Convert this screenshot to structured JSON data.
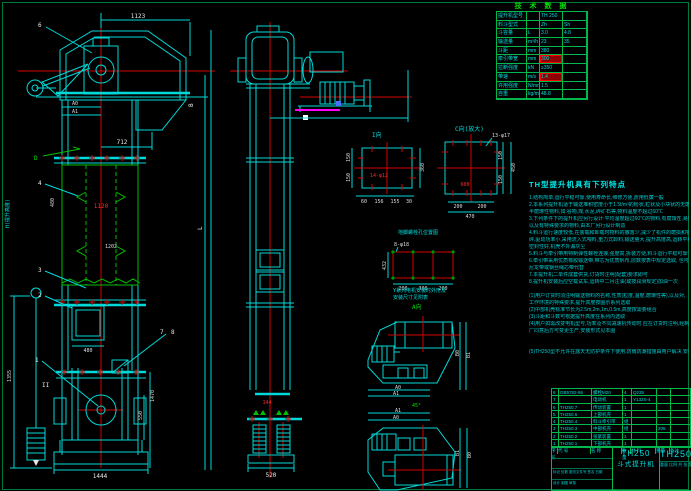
{
  "tech_table": {
    "title": "技 术 数 据",
    "rows": [
      {
        "label": "提升机型号",
        "unit": "",
        "v1": "TH 250",
        "v2": ""
      },
      {
        "label": "料斗型式",
        "unit": "",
        "v1": "Zh",
        "v2": "Sh"
      },
      {
        "label": "斗容量",
        "unit": "L",
        "v1": "3.0",
        "v2": "4.8"
      },
      {
        "label": "输送量",
        "unit": "m³/h",
        "v1": "23",
        "v2": "35"
      },
      {
        "label": "斗距",
        "unit": "mm",
        "v1": "380",
        "v2": ""
      },
      {
        "label": "牵引带宽",
        "unit": "mm",
        "v1": "300",
        "v2": "",
        "hl1": true
      },
      {
        "label": "拉断强度",
        "unit": "kN",
        "v1": "≥350",
        "v2": ""
      },
      {
        "label": "带速",
        "unit": "m/s",
        "v1": "1.4",
        "v2": "",
        "hl1": true
      },
      {
        "label": "许用强度",
        "unit": "N/mm",
        "v1": "1.5",
        "v2": ""
      },
      {
        "label": "自重",
        "unit": "kg/m",
        "v1": "48.8",
        "v2": ""
      }
    ]
  },
  "features": {
    "title": "TH型提升机具有下列特点",
    "lines": [
      "1.结构简单,运行平稳可靠,使用寿命长,维修方便,费用低廉一般",
      "2.本系列提升机适于输送堆积密度小于1.5t/m³的粉状,粒状及小块状的无磨琢性及",
      "  半磨琢性物料,如:谷物,煤,水泥,碎矿石等,物料温度不超过60℃",
      "3.下列条件下的提升机应另行设计:平均温度超过60℃的物料,有腐蚀性,易燃易爆",
      "  以及有特殊要求的物料,由本厂另行设计制造",
      "4.料斗运行速度较低,在装载和卸载时物料的撒落少,减少了机件的磨损和物料的破",
      "  碎,驱动功率小,采用流入式喂料,重力式卸料,输送量大,提升高度高,运转平稳",
      "  密封性好,机壳不外漏灰尘",
      "5.料斗与牵引带用特制弹性螺栓连接,强度高,拆装方便,料斗运行平稳可靠一只",
      "6.牵引带采用优质橡胶输送带,带芯为优质帆布,层数按表中规定选取, 也可采用",
      "  尼龙带或钢丝绳芯带代替",
      "7.本提升机二单件成套供货,订货时注明(配套)要求即可",
      "8.提升机安装后应空载试车,运转中二月注油(或按润滑规定)加油一次",
      "",
      "(1)用户订货时须注明输送物料的名称,性质(粒度,温度,磨琢性等),以及对,",
      "   工作环境的特殊要求,提升高度按图示系列选取",
      "(2)中部机壳标准节长为2.5m,2m,1m,0.5m,高度按需要组合",
      "(3)斗距和斗数可根据提升高度在系列内选取",
      "(4)用户如需改变电机型号,功率及不同减速机传动时 应在订货时注明,经制造",
      "  厂同意后方可变更生产,安装形式见本图",
      "",
      "",
      "(5)TH250型不允许在露天无防护条件下使用,防雨防潮措施由用户解决 安装."
    ]
  },
  "front": {
    "dims": {
      "d1123": "1123",
      "d712": "712",
      "a0": "A0",
      "a1": "A1",
      "d480v": "480",
      "d1120": "1120",
      "d1202": "1202",
      "door480": "480",
      "d1444": "1444",
      "d1355": "1355",
      "d1470": "1470",
      "d550": "550",
      "h_label": "H(提升高度)",
      "l_label": "L",
      "b_label": "B",
      "sec_ii": "II"
    },
    "callouts": {
      "n1": "1",
      "n2": "2",
      "n3": "3",
      "n4": "4",
      "n6": "6",
      "n7": "7",
      "n8": "8",
      "sec_d": "D"
    }
  },
  "side": {
    "d520": "520",
    "d144": "144"
  },
  "detail_i": {
    "label": "I向",
    "hole": "14-φ12",
    "left1": "150",
    "left2": "150",
    "right": "360",
    "b1": "60",
    "b2": "156",
    "b3": "155",
    "b4": "30"
  },
  "detail_c": {
    "label": "C向(放大)",
    "hole": "13-φ17",
    "center": "600",
    "r1": "150",
    "r2": "150",
    "rt": "450",
    "b1": "200",
    "b2": "200",
    "bt": "470"
  },
  "anchor": {
    "title": "地脚螺栓孔位置图",
    "hole": "8-φ18",
    "h": "432",
    "b1": "200",
    "b2": "300",
    "b3": "200"
  },
  "viewa": {
    "note1": "Y系列电机安装时外形及",
    "note2": "安装尺寸见附表",
    "label": "A向",
    "b0": "B0",
    "b1": "B1",
    "a0": "A0",
    "a1": "A1",
    "angle": "45°"
  },
  "viewb": {
    "a1": "A1",
    "a0": "A0",
    "b0": "B0",
    "b1": "B1"
  },
  "bom": {
    "headers": [
      "序号",
      "代 号",
      "名 称",
      "数量",
      "材 料",
      "重量",
      "备注"
    ],
    "rows": [
      [
        "8",
        "GB5782-86",
        "螺栓M20",
        "4",
        "Q235",
        "",
        ""
      ],
      [
        "7",
        "",
        "电动机",
        "1",
        "Y132S-4",
        "",
        ""
      ],
      [
        "6",
        "TH250.7",
        "传动装置",
        "1",
        "",
        "",
        ""
      ],
      [
        "5",
        "TH250.6",
        "上部机壳",
        "1",
        "",
        "",
        ""
      ],
      [
        "4",
        "TH250.4",
        "料斗牵引带",
        "组",
        "",
        "",
        ""
      ],
      [
        "3",
        "TH250.3",
        "中部机壳",
        "组",
        "",
        "205",
        ""
      ],
      [
        "2",
        "TH250.2",
        "张紧装置",
        "1",
        "",
        "",
        ""
      ],
      [
        "1",
        "TH250.1",
        "下部机壳",
        "1",
        "",
        "",
        ""
      ]
    ]
  },
  "title_block": {
    "model": "TH250",
    "name": "斗式提升机",
    "drawing_no": "TH250",
    "rev_line": "标记 处数 更改文件号 签名 日期",
    "roles_line": "设计  制图  审核",
    "scale_line": "重量  比例  共 张 第 张"
  }
}
